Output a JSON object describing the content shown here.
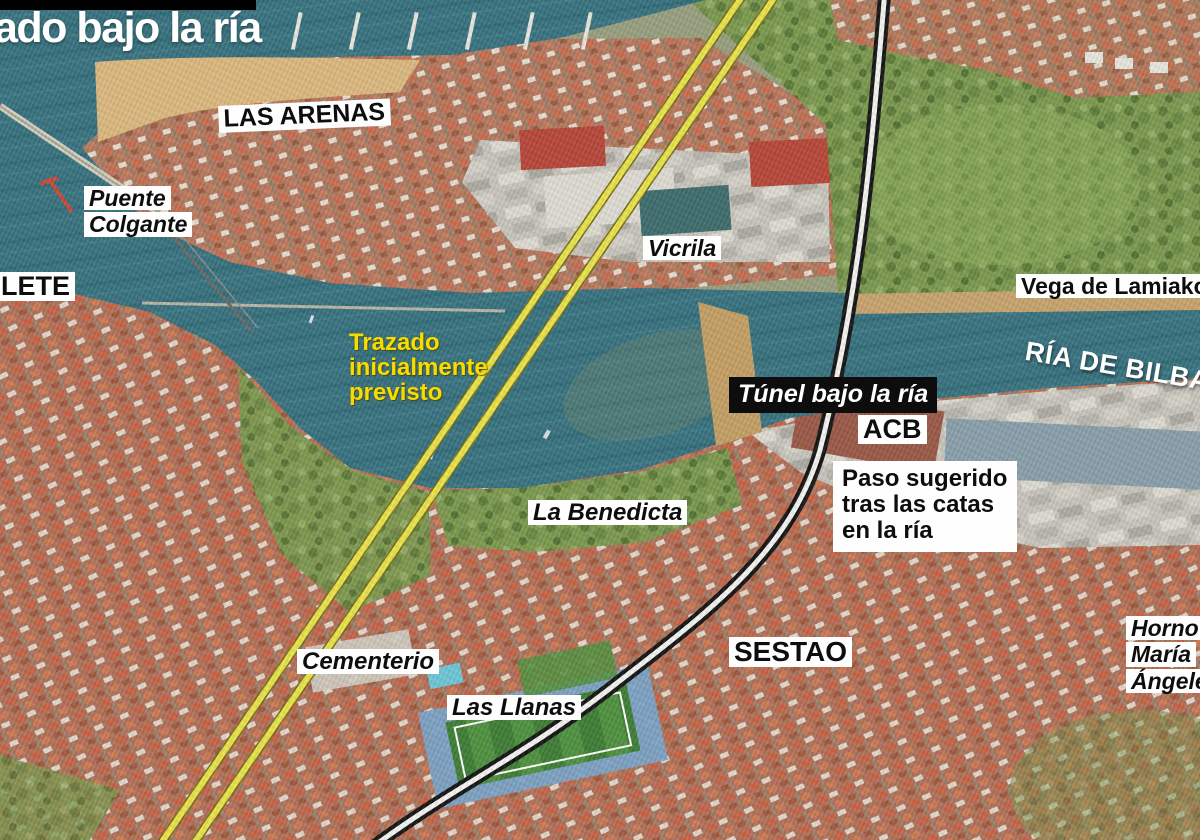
{
  "header": {
    "title_partial": "ado bajo la ría"
  },
  "labels": {
    "las_arenas": "LAS ARENAS",
    "puente_colgante": [
      "Puente",
      "Colgante"
    ],
    "portugalete_partial": "LETE",
    "vicrila": "Vicrila",
    "vega_de_lamiako": "Vega de Lamiako",
    "ria_de_bilbao": "RÍA DE BILBAO",
    "la_benedicta": "La Benedicta",
    "cementerio": "Cementerio",
    "las_llanas": "Las Llanas",
    "sestao": "SESTAO",
    "acb": "ACB",
    "horno_maria_angeles": [
      "Horno",
      "María",
      "Ángeles"
    ]
  },
  "annotations": {
    "planned_route_label": [
      "Trazado",
      "inicialmente",
      "previsto"
    ],
    "tunnel_label": "Túnel bajo la ría",
    "suggested_route_label": [
      "Paso sugerido",
      "tras las catas",
      "en la ría"
    ]
  },
  "legend_colors": {
    "planned_route": "#eae34b",
    "planned_route_text": "#f8dc00",
    "suggested_route": "#151515",
    "suggested_route_casing": "#f4f4f1",
    "water": "#387380",
    "label_box_bg": "#fefefe",
    "label_text": "#0d0d0d",
    "tunnel_box_bg": "#0d0d0d"
  }
}
